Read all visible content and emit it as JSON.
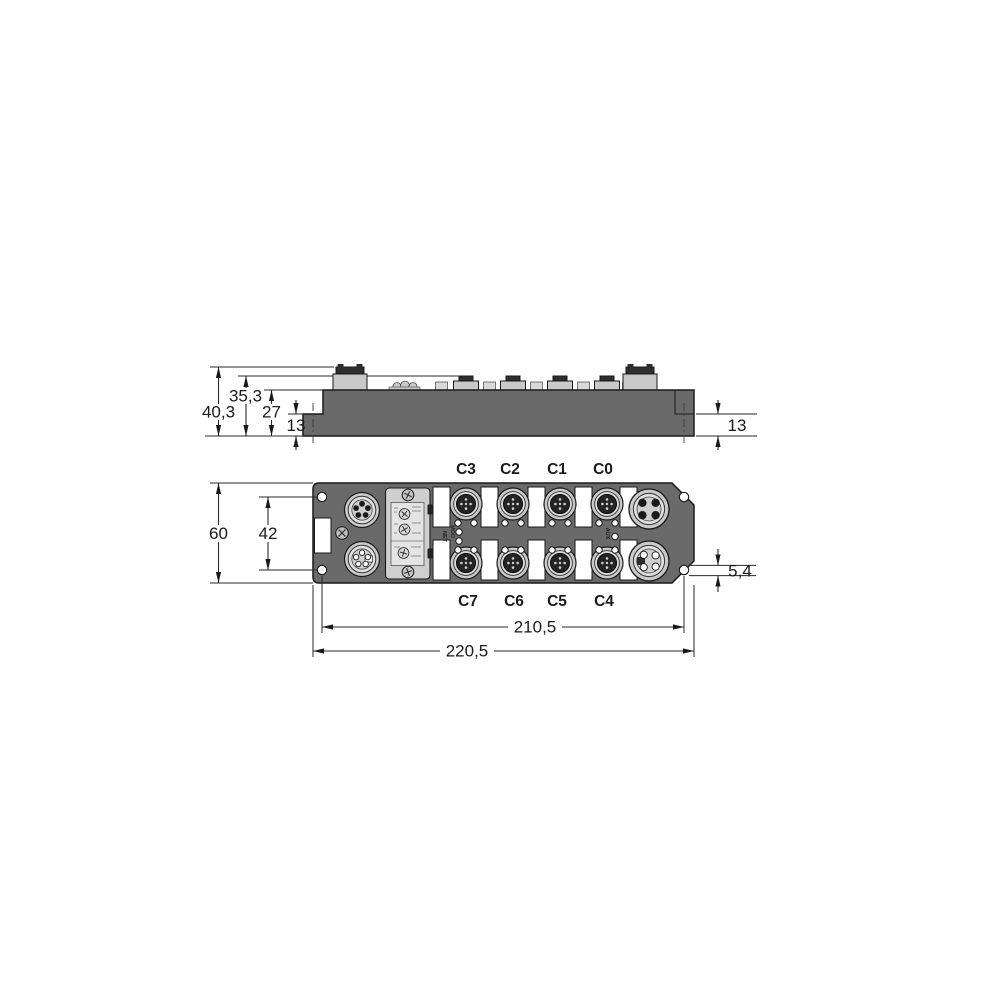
{
  "side": {
    "dim_overall_height": "40,3",
    "dim_connector_height": "35,3",
    "dim_body_height": "27",
    "dim_base_left": "13",
    "dim_base_right": "13"
  },
  "front": {
    "dim_overall_height": "60",
    "dim_mount_hole_spacing_v": "42",
    "dim_mount_hole_dia": "5,4",
    "dim_mount_hole_spacing_h": "210,5",
    "dim_overall_width": "220,5",
    "ports_top": [
      "C3",
      "C2",
      "C1",
      "C0"
    ],
    "ports_bottom": [
      "C7",
      "C6",
      "C5",
      "C4"
    ],
    "indicators": {
      "net": "NET",
      "mod": "MOD",
      "aux": "AUX"
    }
  },
  "colors": {
    "housing": "#6a6a6a",
    "connector": "#c9c9c9",
    "connector_inner": "#dedede",
    "cap": "#2e2e2e",
    "panel": "#cfcfcf",
    "window": "#e4e4e4",
    "white": "#ffffff",
    "line": "#1a1a1a"
  }
}
